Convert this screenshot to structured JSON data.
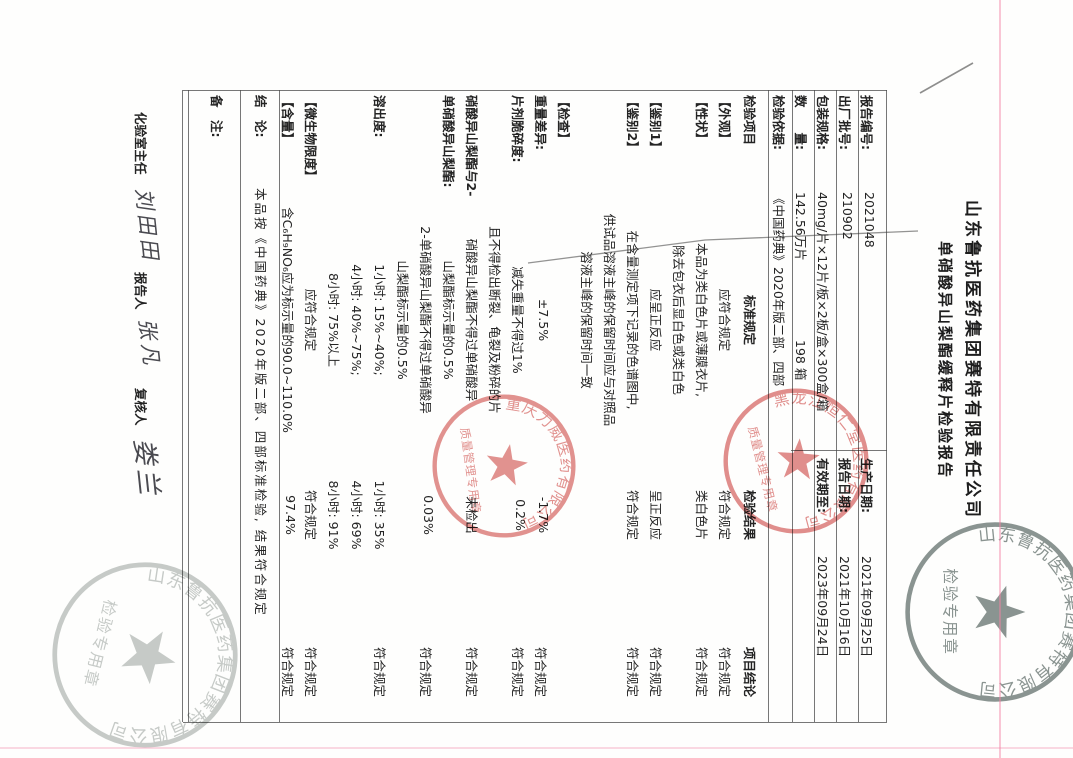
{
  "titles": {
    "company": "山东鲁抗医药集团赛特有限责任公司",
    "report": "单硝酸异山梨酯缓释片检验报告"
  },
  "header_fields": [
    {
      "label": "报告编号:",
      "value": "2021048",
      "label2": "生产日期:",
      "value2": "2021年09月25日"
    },
    {
      "label": "出厂批号:",
      "value": "210902",
      "label2": "报告日期:",
      "value2": "2021年10月16日"
    },
    {
      "label": "包装规格:",
      "value": "40mg/片×12片/板×2板/盒×300盒/箱",
      "label2": "有效期至:",
      "value2": "2023年09月24日"
    },
    {
      "label": "数　　量:",
      "value": "142.56万片",
      "extra": "198 箱"
    },
    {
      "label": "检验依据:",
      "value": "《中国药典》2020年版二部、四部"
    }
  ],
  "table": {
    "columns": [
      "检验项目",
      "标准规定",
      "检验结果",
      "项目结论"
    ],
    "rows": [
      [
        "【外观】",
        "应符合规定",
        "符合规定",
        "符合规定"
      ],
      [
        "【性状】",
        "本品为类白色片或薄膜衣片,",
        "类白色片",
        "符合规定"
      ],
      [
        "",
        "除去包衣后显白色或类白色",
        "",
        ""
      ],
      [
        "【鉴别1】",
        "应呈正反应",
        "呈正反应",
        "符合规定"
      ],
      [
        "【鉴别2】",
        "在含量测定项下记录的色谱图中,",
        "符合规定",
        "符合规定"
      ],
      [
        "",
        "供试品溶液主峰的保留时间应与对照品",
        "",
        ""
      ],
      [
        "",
        "溶液主峰的保留时间一致",
        "",
        ""
      ],
      [
        "【检查】",
        "",
        "",
        ""
      ],
      [
        "重量差异:",
        "±7.5%",
        "-1.7%",
        "符合规定"
      ],
      [
        "片剂脆碎度:",
        "减失重量不得过1%",
        "0.2%",
        "符合规定"
      ],
      [
        "",
        "且不得检出断裂、龟裂及粉碎的片",
        "",
        ""
      ],
      [
        "硝酸异山梨酯与2-",
        "硝酸异山梨酯不得过单硝酸异",
        "未检出",
        "符合规定"
      ],
      [
        "单硝酸异山梨酯:",
        "山梨酯标示量的0.5%",
        "",
        ""
      ],
      [
        "",
        "2-单硝酸异山梨酯不得过单硝酸异",
        "0.03%",
        "符合规定"
      ],
      [
        "",
        "山梨酯标示量的0.5%",
        "",
        ""
      ],
      [
        "溶出度:",
        "1小时: 15%~40%;",
        "1小时: 35%",
        "符合规定"
      ],
      [
        "",
        "4小时: 40%~75%;",
        "4小时: 69%",
        ""
      ],
      [
        "",
        "8小时: 75%以上",
        "8小时: 91%",
        ""
      ],
      [
        "【微生物限度】",
        "应符合规定",
        "符合规定",
        "符合规定"
      ],
      [
        "【含量】",
        "含C₆H₉NO₆应为标示量的90.0~110.0%",
        "97.4%",
        "符合规定"
      ]
    ]
  },
  "conclusion": {
    "label": "结　论:",
    "text": "本品按《中国药典》2020年版二部、四部标准检验, 结果符合规定"
  },
  "remark": {
    "label": "备　注:"
  },
  "signatures": {
    "lab_director_label": "化验室主任",
    "lab_director_name": "刘田田",
    "reporter_label": "报告人",
    "reporter_name": "张凡",
    "reviewer_label": "复核人",
    "reviewer_name": "娄兰"
  },
  "stamps": {
    "company_seal_arc": "山东鲁抗医药集团赛特有限公司",
    "inspection_seal_caption": "检验专用章",
    "red_stamp_1_arc": "黑龙江恒仁堂医药有限公司",
    "red_stamp_1_caption": "质量管理专用章",
    "red_stamp_2_arc": "重庆力威医药有限公司",
    "red_stamp_2_caption": "质量管理专用章"
  },
  "colors": {
    "red_stamp": "#cf4a46",
    "gray_stamp_dark": "#6e7a76",
    "gray_stamp_light": "#98a09c",
    "paper": "#fefefd",
    "ink": "#242424"
  }
}
